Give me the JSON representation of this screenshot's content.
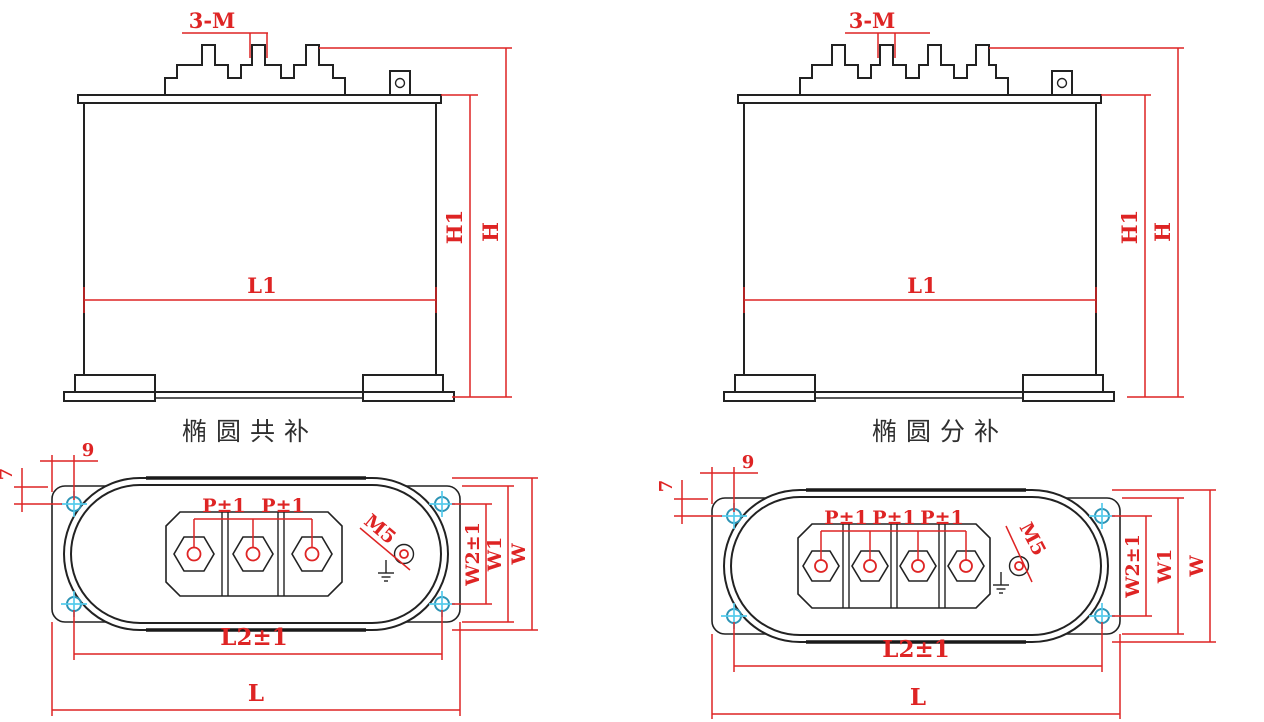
{
  "document": {
    "type": "capacitor-dimension-drawing",
    "background": "#ffffff"
  },
  "colors": {
    "outline": "#222222",
    "dimension": "#de2424",
    "hole_marker_circle": "#2c93b4",
    "hole_marker_cross": "#55cbec",
    "title_text": "#2f2f2f"
  },
  "views": {
    "front_common": {
      "title": "椭圆共补"
    },
    "front_split": {
      "title": "椭圆分补"
    }
  },
  "dims": {
    "terminal_thread": "3-M",
    "body_height": "H1",
    "total_height": "H",
    "body_length": "L1",
    "hole_offset_horizontal": "9",
    "hole_offset_vertical": "7",
    "terminal_pitch": "P±1",
    "ground_thread": "M5",
    "hole_span_width": "W2±1",
    "flange_width": "W1",
    "case_width": "W",
    "hole_span_length": "L2±1",
    "flange_length": "L"
  }
}
